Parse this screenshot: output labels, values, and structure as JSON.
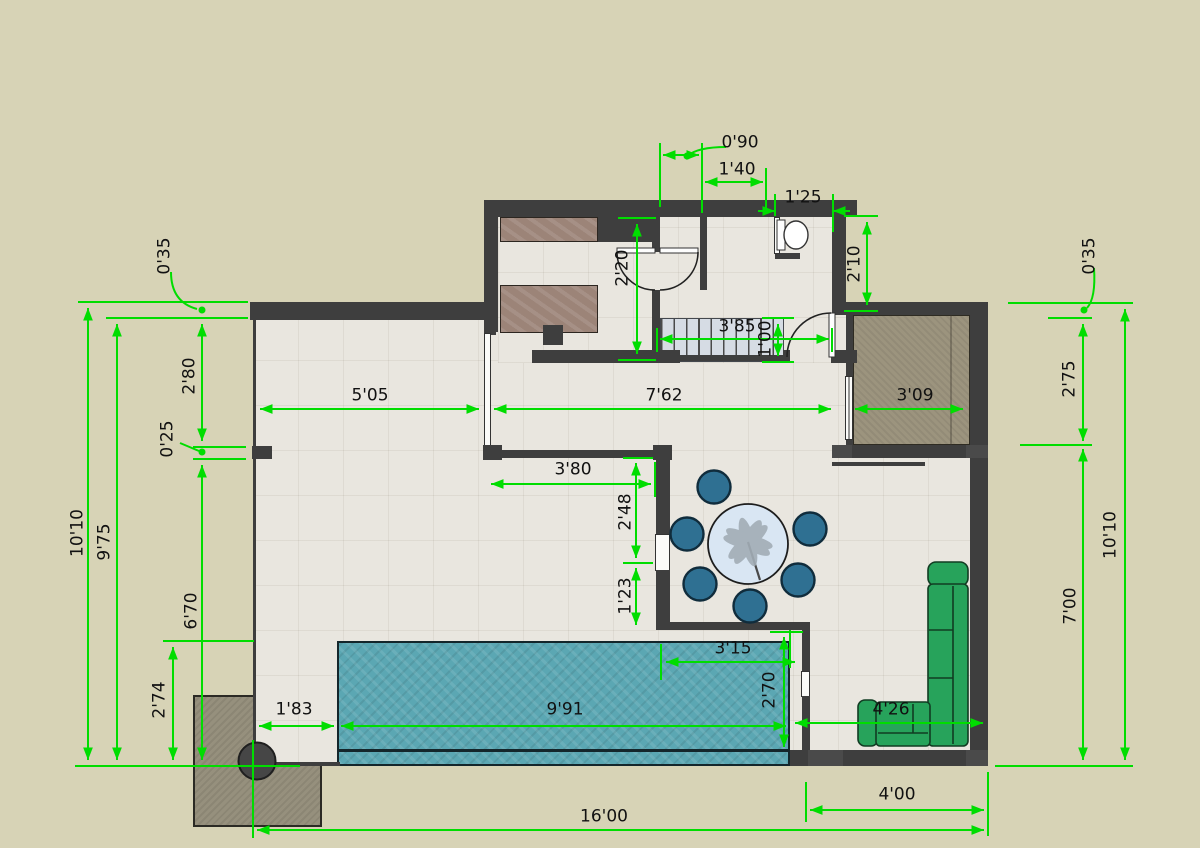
{
  "drawing": {
    "type": "architectural-floor-plan",
    "units": "meters",
    "rooms": [
      "kitchen",
      "closet",
      "hallway",
      "bathroom",
      "entry-porch",
      "foyer",
      "dining-area",
      "living-area",
      "terrace"
    ],
    "furniture": [
      "kitchen-counter",
      "kitchen-island-counter",
      "appliance-block",
      "toilet",
      "staircase",
      "round-dining-table",
      "dining-chair-x6",
      "l-shaped-sofa",
      "swimming-pool",
      "planter",
      "round-column"
    ]
  },
  "colors": {
    "dimension_green": "#00dd00",
    "wall_dark": "#3e3e3e",
    "exterior_ground": "#d7d3b6",
    "floor_tile": "#e9e6df",
    "pool_water": "#5ba7b3",
    "porch_floor": "#9c947e",
    "planter_fill": "#96907d",
    "counter_brown": "#9c8478",
    "sofa_green": "#27a35b",
    "chair_blue": "#2f7092",
    "table_top": "#d9e6f3",
    "stairs_fill": "#d6dce4"
  },
  "dims": {
    "d0_90": "0'90",
    "d1_40": "1'40",
    "d1_25": "1'25",
    "d2_20": "2'20",
    "d2_10": "2'10",
    "d3_85": "3'85",
    "d1_00": "1'00",
    "d0_35": "0'35",
    "d2_80": "2'80",
    "d0_25": "0'25",
    "d10_10": "10'10",
    "d9_75": "9'75",
    "d6_70": "6'70",
    "d2_74": "2'74",
    "d5_05": "5'05",
    "d7_62": "7'62",
    "d3_09": "3'09",
    "d3_80": "3'80",
    "d2_48": "2'48",
    "d1_23": "1'23",
    "d3_15": "3'15",
    "d2_70": "2'70",
    "d9_91": "9'91",
    "d1_83": "1'83",
    "d4_26": "4'26",
    "d4_00": "4'00",
    "d16_00": "16'00",
    "d2_75": "2'75",
    "d7_00": "7'00"
  }
}
